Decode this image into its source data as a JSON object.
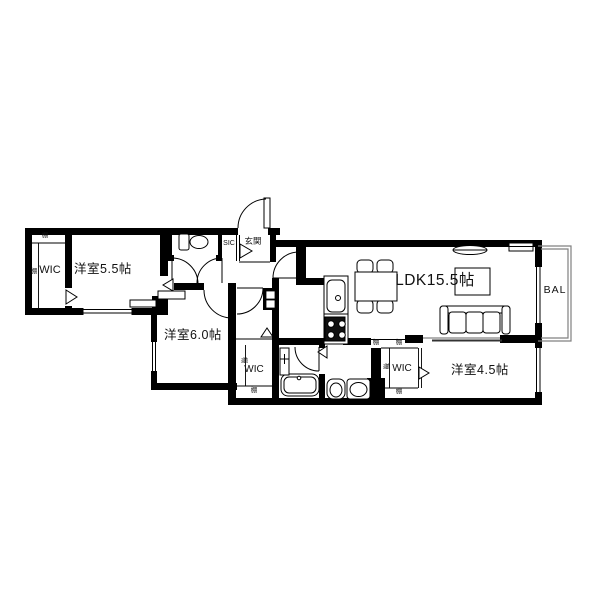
{
  "floorplan": {
    "labels": {
      "room_5_5": "洋室5.5帖",
      "room_6_0": "洋室6.0帖",
      "room_4_5": "洋室4.5帖",
      "ldk": "LDK15.5帖",
      "wic": "WIC",
      "sic": "SIC",
      "entrance": "玄関",
      "balcony": "BAL",
      "shelf": "棚"
    },
    "colors": {
      "wall": "#000000",
      "background": "#ffffff",
      "thin_line": "#808080"
    }
  }
}
